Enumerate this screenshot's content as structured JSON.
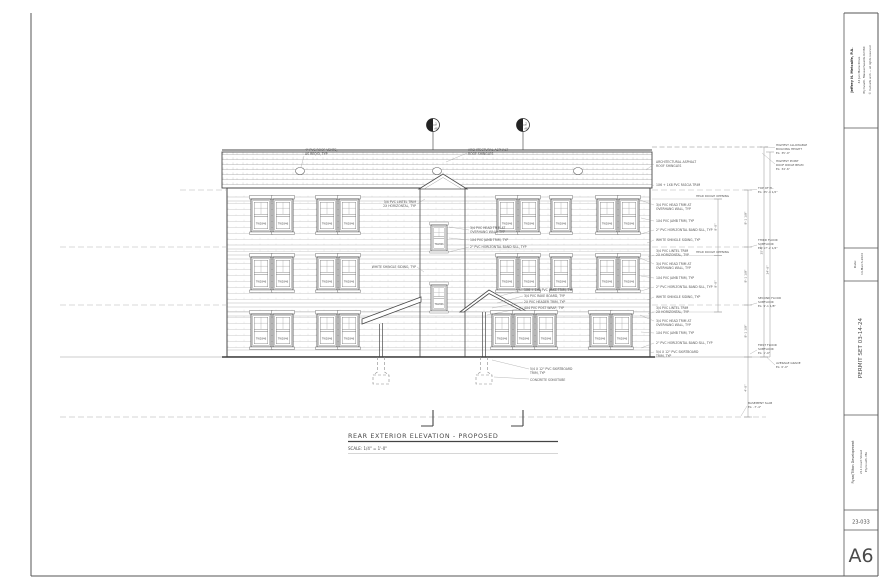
{
  "sheet": {
    "paper_color": "#ffffff",
    "line_color": "#444444"
  },
  "title_block": {
    "architect_name": "Jeffrey N. Metcalfe, P.A.",
    "architect_address1": "44 Jan Marie Drive",
    "architect_address2": "Plymouth, Massachusetts 02360",
    "architect_note": "© metcalfe arch — all rights reserved",
    "date_label": "Date:",
    "date_value": "14-March-2024",
    "permit_set": "PERMIT SET  03-14-24",
    "client": "Ryan/Tilton Development",
    "project_address1": "211 Court Street",
    "project_address2": "Plymouth, MA",
    "job_number": "23-033",
    "sheet_number": "A6"
  },
  "drawing": {
    "title": "REAR EXTERIOR ELEVATION - PROPOSED",
    "scale": "SCALE: 1/4\" = 1'-0\"",
    "window_tag": "TW2846",
    "markers": {
      "left_num": "1",
      "left_sheet": "A8",
      "right_num": "2",
      "right_sheet": "A8"
    },
    "callouts": {
      "roof_vent_1": "4\" PVC ROOF VENTS,",
      "roof_vent_2": "AS REQ'D, TYP",
      "roof_shingles_1": "ARCHITECTURAL ASPHALT",
      "roof_shingles_2": "ROOF SHINGLES",
      "fascia": "1X6 + 1X8 PVC FASCIA TRIM",
      "head_ro": "HEAD ROUGH OPENING",
      "lintel_1": "3/4 PVC LINTEL TRIM",
      "lintel_2": "2X HORIZONTAL, TYP",
      "head_trim_1": "3/4 PVC HEAD TRIM AT",
      "head_trim_2": "OVERHANG WALL, TYP",
      "jamb": "1X4 PVC JAMB TRIM, TYP",
      "sill": "2\" PVC HORIZONTAL BAND SILL, TYP",
      "siding": "WHITE SHINGLE SIDING, TYP",
      "rake": "1X6 + 1X8 PVC RAKE TRIM, TYP",
      "rake_board": "3/4 PVC RAKE BOARD, TYP",
      "header": "2X PVC HEADER TRIM, TYP",
      "post": "4X4 PVC POST WRAP, TYP",
      "skirt_1": "5/4 X 12\" PVC SKIRTBOARD",
      "skirt_2": "TRIM, TYP",
      "sonotube": "CONCRETE SONOTUBE"
    },
    "levels": {
      "max_1": "HIGHEST ALLOWABLE",
      "max_2": "BUILDING HEIGHT",
      "max_el": "EL: 35'-0\"",
      "ridge_1": "HIGHEST POINT",
      "ridge_2": "ROOF RIDGE BEAM",
      "ridge_el": "EL: 34'-6\"",
      "plate_1": "TOP OF PL.",
      "plate_el": "EL: 25'-4 1/2\"",
      "third_1": "THIRD FLOOR",
      "third_2": "SUBFLOOR",
      "third_el": "EL: 17'-2 1/4\"",
      "second_1": "SECOND FLOOR",
      "second_2": "SUBFLOOR",
      "second_el": "EL: 9'-1 1/8\"",
      "first_1": "FIRST FLOOR",
      "first_2": "SUBFLOOR",
      "first_el": "EL: 1'-0\"",
      "grade_1": "AVERAGE GRADE",
      "grade_el": "EL: 0'-0\"",
      "basement_1": "BASEMENT SLAB",
      "basement_el": "EL: -7'-4\""
    },
    "dims": {
      "floor_height": "8'-1 1/8\"",
      "overall_max": "35'-0\"",
      "overall_ridge": "34'-6\"",
      "head_height": "8'-0\"",
      "below_grade": "4'-0\""
    }
  }
}
